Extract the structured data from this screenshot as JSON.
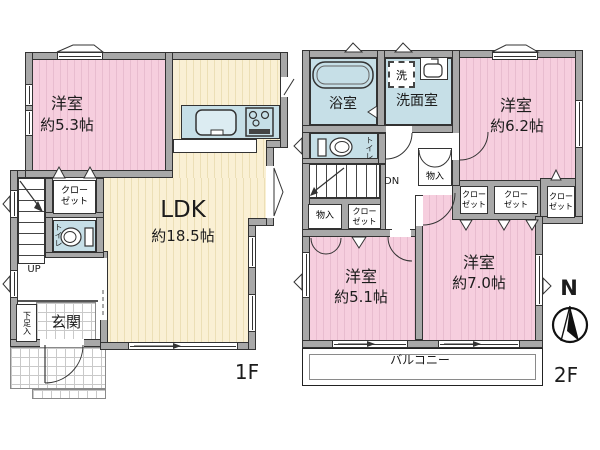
{
  "colors": {
    "pink": "#f6cede",
    "cream": "#faf0d4",
    "blue": "#c6dfe7",
    "wall": "#a8a8a8"
  },
  "f1": {
    "floor_label": "1F",
    "western_room": {
      "name": "洋室",
      "size": "約5.3帖"
    },
    "ldk": {
      "name": "LDK",
      "size": "約18.5帖"
    },
    "closet_line1": "クロー",
    "closet_line2": "ゼット",
    "toilet": "トイレ",
    "stairs_up": "UP",
    "entrance": "玄関",
    "shoe_storage": "下足入"
  },
  "f2": {
    "floor_label": "2F",
    "bathroom": "浴室",
    "washroom": "洗面室",
    "laundry": "洗",
    "toilet": "トイレ",
    "stairs_down": "DN",
    "storage": "物入",
    "closet_line1": "クロー",
    "closet_line2": "ゼット",
    "western_room_62": {
      "name": "洋室",
      "size": "約6.2帖"
    },
    "western_room_51": {
      "name": "洋室",
      "size": "約5.1帖"
    },
    "western_room_70": {
      "name": "洋室",
      "size": "約7.0帖"
    },
    "balcony": "バルコニー",
    "compass_north": "N"
  }
}
